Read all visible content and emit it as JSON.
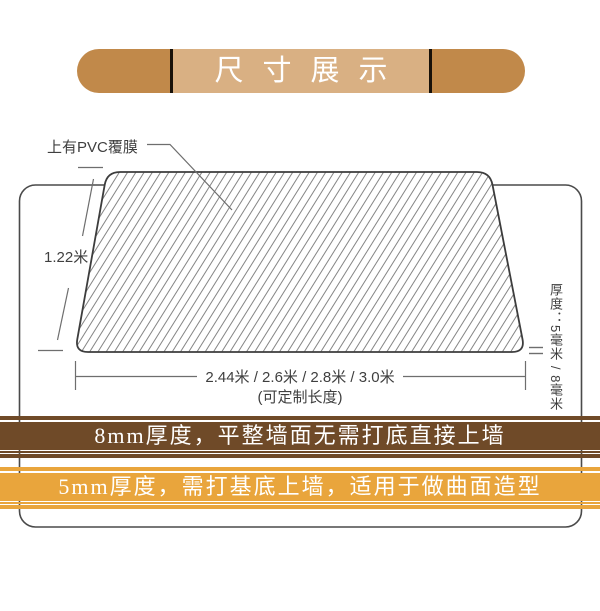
{
  "title_banner": {
    "text": "尺寸展示"
  },
  "diagram": {
    "pvc_label": "上有PVC覆膜",
    "height_label": "1.22米",
    "length_label": "2.44米 / 2.6米 / 2.8米 / 3.0米",
    "length_note": "(可定制长度)",
    "thickness_label": "厚度：5毫米 / 8毫米"
  },
  "banners": [
    {
      "text": "8mm厚度，平整墙面无需打底直接上墙",
      "color": "#6f4a28"
    },
    {
      "text": "5mm厚度，需打基底上墙，适用于做曲面造型",
      "color": "#e9a53c"
    }
  ],
  "colors": {
    "title_cap": "#c1894a",
    "title_center": "#d9b083",
    "title_divider": "#181109",
    "title_text": "#ffffff",
    "banner_text": "#ffffff",
    "frame_outline": "#4a4a4a",
    "panel_outline": "#3d3d3d",
    "hatch_line": "#858585",
    "dimension_line": "#6e6e6e",
    "label_text": "#3f3f3f"
  }
}
